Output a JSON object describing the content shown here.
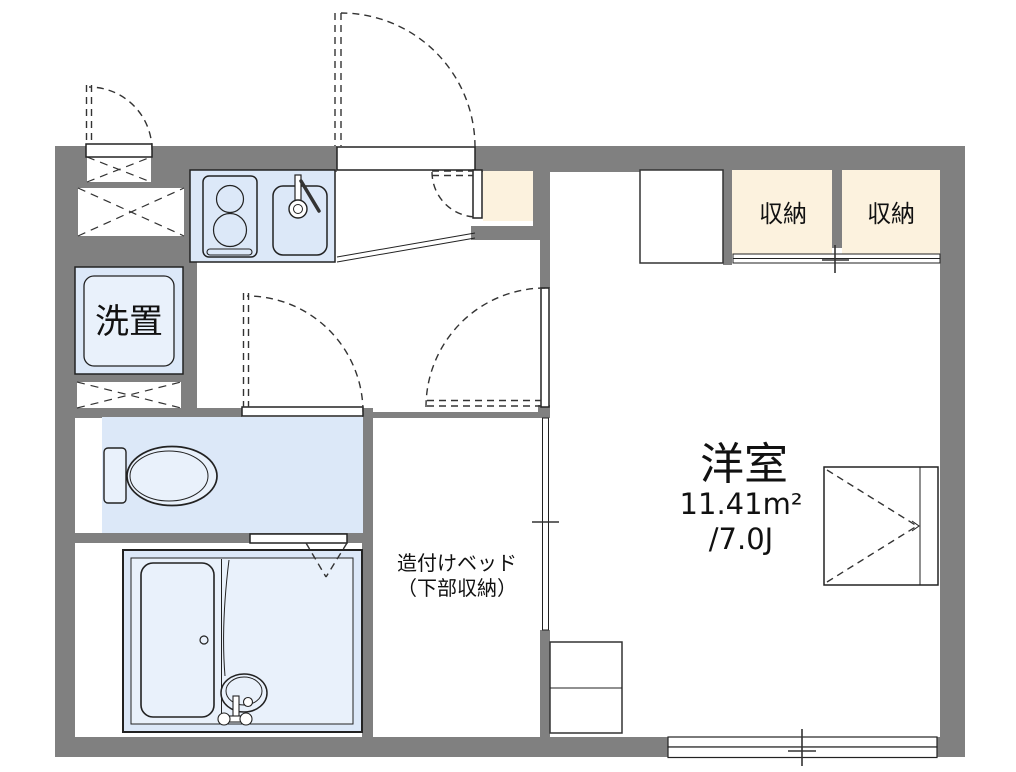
{
  "colors": {
    "wall": "#808080",
    "fixture": "#dce8f8",
    "fixture_light": "#e9f1fb",
    "closet": "#fcf2de",
    "line": "#222222",
    "text": "#111111"
  },
  "labels": {
    "western_room": "洋室",
    "western_room_area_m2": "11.41m²",
    "western_room_area_jo": "/7.0J",
    "closet_left": "収納",
    "closet_right": "収納",
    "laundry_space": "洗置",
    "built_in_bed_line1": "造付けベッド",
    "built_in_bed_line2": "（下部収納）"
  },
  "rooms": [
    {
      "name": "western-room",
      "label": "洋室",
      "area": "11.41m² /7.0J"
    },
    {
      "name": "kitchen"
    },
    {
      "name": "entrance"
    },
    {
      "name": "hallway"
    },
    {
      "name": "toilet"
    },
    {
      "name": "bathroom"
    },
    {
      "name": "built-in-bed-space",
      "label": "造付けベッド（下部収納）"
    },
    {
      "name": "closet-left",
      "label": "収納"
    },
    {
      "name": "closet-right",
      "label": "収納"
    },
    {
      "name": "laundry-space",
      "label": "洗置"
    }
  ]
}
